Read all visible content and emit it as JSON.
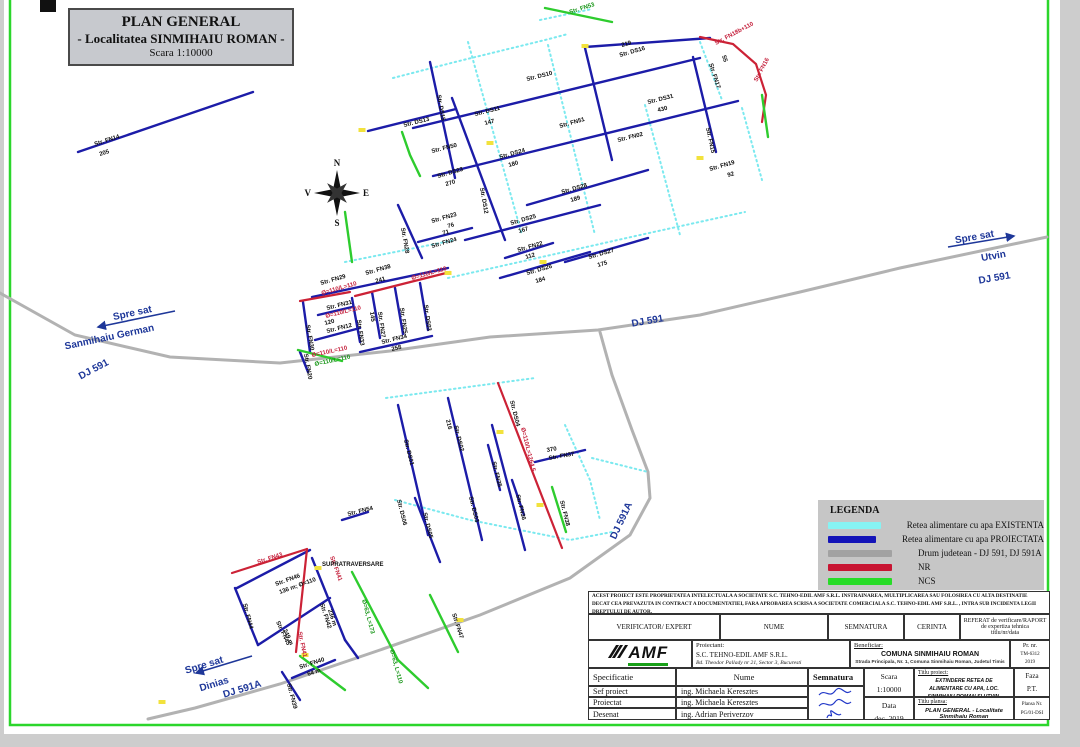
{
  "page": {
    "background": "#cdcdcd",
    "sheet": "#ffffff",
    "frame": "#2bd62b",
    "accent_blue": "#1c1ca8",
    "accent_cyan": "#7be9ef",
    "accent_red": "#cc2236",
    "accent_green": "#2ecc2e",
    "road_gray": "#b2b2b2"
  },
  "title_box": {
    "line1": "PLAN GENERAL",
    "line2": "- Localitatea SINMIHAIU ROMAN -",
    "line3": "Scara 1:10000"
  },
  "compass": {
    "n": "N",
    "e": "E",
    "s": "S",
    "v": "V"
  },
  "legend": {
    "title": "LEGENDA",
    "items": [
      {
        "color": "#86f3f3",
        "label": "Retea alimentare cu apa EXISTENTA"
      },
      {
        "color": "#1414b8",
        "label": "Retea alimentare cu apa PROIECTATA"
      },
      {
        "color": "#a2a2a2",
        "label": "Drum judetean - DJ 591, DJ 591A"
      },
      {
        "color": "#c81432",
        "label": "NR"
      },
      {
        "color": "#28dc28",
        "label": "NCS"
      }
    ]
  },
  "map": {
    "road_labels": [
      {
        "t": "Spre sat",
        "x": 975,
        "y": 240,
        "r": -10,
        "s": 10
      },
      {
        "t": "Utvin",
        "x": 994,
        "y": 259,
        "r": -10,
        "s": 10
      },
      {
        "t": "DJ 591",
        "x": 995,
        "y": 281,
        "r": -10,
        "s": 9
      },
      {
        "t": "Spre sat",
        "x": 133,
        "y": 316,
        "r": -12,
        "s": 10
      },
      {
        "t": "Sanmihaiu German",
        "x": 110,
        "y": 340,
        "r": -12,
        "s": 10
      },
      {
        "t": "DJ 591",
        "x": 95,
        "y": 372,
        "r": -28,
        "s": 9
      },
      {
        "t": "DJ 591",
        "x": 648,
        "y": 324,
        "r": -10,
        "s": 9
      },
      {
        "t": "DJ 591A",
        "x": 624,
        "y": 522,
        "r": -65,
        "s": 9
      },
      {
        "t": "Spre sat",
        "x": 205,
        "y": 668,
        "r": -17,
        "s": 10
      },
      {
        "t": "Dinias",
        "x": 215,
        "y": 687,
        "r": -17,
        "s": 10
      },
      {
        "t": "DJ 591A",
        "x": 243,
        "y": 692,
        "r": -17,
        "s": 9
      }
    ],
    "labels": [
      {
        "t": "Str. FN14",
        "x": 95,
        "y": 146,
        "r": -18
      },
      {
        "t": "205",
        "x": 100,
        "y": 156,
        "r": -18
      },
      {
        "t": "Str. DS15",
        "x": 437,
        "y": 95,
        "r": 80
      },
      {
        "t": "Str. DS13",
        "x": 404,
        "y": 127,
        "r": -14
      },
      {
        "t": "Str. FN50",
        "x": 432,
        "y": 153,
        "r": -14
      },
      {
        "t": "Str. DS11",
        "x": 475,
        "y": 116,
        "r": -14
      },
      {
        "t": "147",
        "x": 485,
        "y": 125,
        "r": -14
      },
      {
        "t": "Str. DS10",
        "x": 527,
        "y": 81,
        "r": -14
      },
      {
        "t": "Str. DS16",
        "x": 620,
        "y": 57,
        "r": -16
      },
      {
        "t": "219",
        "x": 622,
        "y": 47,
        "r": -16
      },
      {
        "t": "Str. FN53",
        "x": 570,
        "y": 14,
        "r": -18,
        "c": "g"
      },
      {
        "t": "Str. FN18b+110",
        "x": 716,
        "y": 45,
        "r": -28,
        "c": "r"
      },
      {
        "t": "Str. FN16",
        "x": 757,
        "y": 82,
        "r": -62,
        "c": "r"
      },
      {
        "t": "Str. FN17",
        "x": 709,
        "y": 64,
        "r": 72
      },
      {
        "t": "55",
        "x": 722,
        "y": 56,
        "r": 72
      },
      {
        "t": "Str. DS31",
        "x": 648,
        "y": 104,
        "r": -14
      },
      {
        "t": "430",
        "x": 658,
        "y": 112,
        "r": -14
      },
      {
        "t": "Str. FN15",
        "x": 706,
        "y": 128,
        "r": 78
      },
      {
        "t": "Str. FN51",
        "x": 560,
        "y": 128,
        "r": -16
      },
      {
        "t": "Str. FN02",
        "x": 618,
        "y": 142,
        "r": -14
      },
      {
        "t": "Str. DS12",
        "x": 480,
        "y": 188,
        "r": 80
      },
      {
        "t": "Str. DS23",
        "x": 438,
        "y": 178,
        "r": -16
      },
      {
        "t": "270",
        "x": 446,
        "y": 186,
        "r": -16
      },
      {
        "t": "Str. DS24",
        "x": 500,
        "y": 159,
        "r": -16
      },
      {
        "t": "180",
        "x": 509,
        "y": 167,
        "r": -16
      },
      {
        "t": "Str. DS28",
        "x": 562,
        "y": 194,
        "r": -16
      },
      {
        "t": "189",
        "x": 571,
        "y": 202,
        "r": -16
      },
      {
        "t": "Str. DS25",
        "x": 511,
        "y": 225,
        "r": -16
      },
      {
        "t": "167",
        "x": 519,
        "y": 233,
        "r": -16
      },
      {
        "t": "Str. FN22",
        "x": 518,
        "y": 252,
        "r": -16
      },
      {
        "t": "112",
        "x": 526,
        "y": 259,
        "r": -16
      },
      {
        "t": "Str. DS26",
        "x": 527,
        "y": 275,
        "r": -16
      },
      {
        "t": "184",
        "x": 536,
        "y": 283,
        "r": -16
      },
      {
        "t": "Str. DS27",
        "x": 589,
        "y": 259,
        "r": -16
      },
      {
        "t": "175",
        "x": 598,
        "y": 267,
        "r": -16
      },
      {
        "t": "Str. FN19",
        "x": 710,
        "y": 171,
        "r": -16
      },
      {
        "t": "92",
        "x": 728,
        "y": 177,
        "r": -16
      },
      {
        "t": "Str. FN23",
        "x": 432,
        "y": 223,
        "r": -16
      },
      {
        "t": "76",
        "x": 448,
        "y": 228,
        "r": -16
      },
      {
        "t": "71",
        "x": 443,
        "y": 235,
        "r": -16
      },
      {
        "t": "Str. FN24",
        "x": 432,
        "y": 248,
        "r": -16
      },
      {
        "t": "Str. FN38",
        "x": 366,
        "y": 275,
        "r": -16
      },
      {
        "t": "241",
        "x": 376,
        "y": 283,
        "r": -16
      },
      {
        "t": "Str. FN29",
        "x": 321,
        "y": 285,
        "r": -16
      },
      {
        "t": "Ø=110/L=110",
        "x": 322,
        "y": 295,
        "r": -16,
        "c": "r"
      },
      {
        "t": "Ø=110/L=110",
        "x": 412,
        "y": 280,
        "r": -16,
        "c": "r"
      },
      {
        "t": "Str. FN31",
        "x": 327,
        "y": 310,
        "r": -14
      },
      {
        "t": "Ø=110/L=110",
        "x": 326,
        "y": 318,
        "r": -14,
        "c": "r"
      },
      {
        "t": "120",
        "x": 325,
        "y": 325,
        "r": -14
      },
      {
        "t": "Str. FN12",
        "x": 327,
        "y": 333,
        "r": -14
      },
      {
        "t": "Str. FN30",
        "x": 306,
        "y": 325,
        "r": 80
      },
      {
        "t": "Str. FN33",
        "x": 357,
        "y": 320,
        "r": 82
      },
      {
        "t": "145",
        "x": 370,
        "y": 312,
        "r": 82
      },
      {
        "t": "Str. FN27",
        "x": 378,
        "y": 312,
        "r": 82
      },
      {
        "t": "Str. FN25",
        "x": 400,
        "y": 308,
        "r": 82
      },
      {
        "t": "Str. DS03",
        "x": 424,
        "y": 305,
        "r": 82
      },
      {
        "t": "Str. FN28",
        "x": 401,
        "y": 228,
        "r": 80
      },
      {
        "t": "Str. FN34",
        "x": 382,
        "y": 344,
        "r": -14
      },
      {
        "t": "258",
        "x": 392,
        "y": 351,
        "r": -14
      },
      {
        "t": "Str. FN20",
        "x": 304,
        "y": 354,
        "r": 80
      },
      {
        "t": "Ø=110/L=110",
        "x": 312,
        "y": 357,
        "r": -12,
        "c": "r"
      },
      {
        "t": "Ø=110/L=110",
        "x": 315,
        "y": 366,
        "r": -12,
        "c": "g"
      },
      {
        "t": "Str. DS04",
        "x": 510,
        "y": 401,
        "r": 76
      },
      {
        "t": "Ø=110/L=1264.5",
        "x": 521,
        "y": 428,
        "r": 76,
        "c": "r"
      },
      {
        "t": "216",
        "x": 446,
        "y": 420,
        "r": 76
      },
      {
        "t": "Str. DS02",
        "x": 454,
        "y": 426,
        "r": 76
      },
      {
        "t": "Str. DS01",
        "x": 404,
        "y": 440,
        "r": 76
      },
      {
        "t": "Str. DS06",
        "x": 397,
        "y": 500,
        "r": 76
      },
      {
        "t": "Str. DS05",
        "x": 423,
        "y": 513,
        "r": 76
      },
      {
        "t": "Str. FN35",
        "x": 492,
        "y": 462,
        "r": 76
      },
      {
        "t": "Str. DS03",
        "x": 469,
        "y": 497,
        "r": 76
      },
      {
        "t": "370",
        "x": 547,
        "y": 452,
        "r": -10
      },
      {
        "t": "Str. FN37",
        "x": 549,
        "y": 460,
        "r": -10
      },
      {
        "t": "Str. FN36",
        "x": 516,
        "y": 495,
        "r": 76
      },
      {
        "t": "Str. FN38",
        "x": 560,
        "y": 501,
        "r": 76
      },
      {
        "t": "Str. FN54",
        "x": 348,
        "y": 516,
        "r": -14
      },
      {
        "t": "Str. FN43",
        "x": 258,
        "y": 564,
        "r": -18,
        "c": "r"
      },
      {
        "t": "Str. FN41",
        "x": 330,
        "y": 557,
        "r": 70,
        "c": "r"
      },
      {
        "t": "SUPRATRAVERSARE",
        "x": 322,
        "y": 566,
        "r": 0
      },
      {
        "t": "Str. FN46",
        "x": 276,
        "y": 586,
        "r": -20
      },
      {
        "t": "136 m; Ø=110",
        "x": 280,
        "y": 594,
        "r": -20
      },
      {
        "t": "Str. FN44",
        "x": 243,
        "y": 604,
        "r": 75
      },
      {
        "t": "Str. FN45",
        "x": 276,
        "y": 622,
        "r": 65
      },
      {
        "t": "249 m",
        "x": 283,
        "y": 630,
        "r": 65
      },
      {
        "t": "Str. FN42",
        "x": 320,
        "y": 604,
        "r": 72
      },
      {
        "t": "236 m",
        "x": 328,
        "y": 610,
        "r": 72
      },
      {
        "t": "Str. FN41",
        "x": 298,
        "y": 632,
        "r": 78,
        "c": "r"
      },
      {
        "t": "Str. FN47",
        "x": 452,
        "y": 614,
        "r": 72
      },
      {
        "t": "Ø=63, L=173",
        "x": 362,
        "y": 600,
        "r": 75,
        "c": "g"
      },
      {
        "t": "Ø=63, L=110",
        "x": 390,
        "y": 650,
        "r": 75,
        "c": "g"
      },
      {
        "t": "Str. FN40",
        "x": 300,
        "y": 669,
        "r": -18
      },
      {
        "t": "64 m",
        "x": 308,
        "y": 676,
        "r": -18
      },
      {
        "t": "Str. FN39",
        "x": 287,
        "y": 684,
        "r": 75
      }
    ],
    "lines": [
      {
        "c": "road",
        "p": "0,293 75,335 170,357 280,363 390,351 490,337 598,330 700,315 800,292 900,268 1047,237"
      },
      {
        "c": "road",
        "p": "600,332 612,375 632,430 648,472 650,498 630,535 570,578 480,615 380,650 280,684 195,708 148,719"
      },
      {
        "c": "c",
        "p": "393,78 455,62 545,40 568,34"
      },
      {
        "c": "c",
        "p": "540,20 592,9"
      },
      {
        "c": "c",
        "p": "468,42 522,235"
      },
      {
        "c": "c",
        "p": "548,45 595,235"
      },
      {
        "c": "c",
        "p": "448,278 640,235 745,212"
      },
      {
        "c": "c",
        "p": "645,105 680,235"
      },
      {
        "c": "c",
        "p": "700,42 722,100"
      },
      {
        "c": "c",
        "p": "742,108 762,180"
      },
      {
        "c": "c",
        "p": "345,262 455,240"
      },
      {
        "c": "c",
        "p": "386,398 535,378"
      },
      {
        "c": "c",
        "p": "395,500 470,520 570,540 612,532"
      },
      {
        "c": "c",
        "p": "565,425 590,480 600,520"
      },
      {
        "c": "c",
        "p": "592,458 648,472"
      },
      {
        "c": "b",
        "p": "78,152 253,92"
      },
      {
        "c": "b",
        "p": "368,131 456,109"
      },
      {
        "c": "b",
        "p": "413,128 700,58"
      },
      {
        "c": "b",
        "p": "585,47 710,38"
      },
      {
        "c": "b",
        "p": "433,176 738,101"
      },
      {
        "c": "b",
        "p": "527,205 648,170"
      },
      {
        "c": "b",
        "p": "465,240 600,205"
      },
      {
        "c": "b",
        "p": "505,258 553,243"
      },
      {
        "c": "b",
        "p": "500,278 590,252"
      },
      {
        "c": "b",
        "p": "565,262 648,238"
      },
      {
        "c": "b",
        "p": "452,98 505,240"
      },
      {
        "c": "b",
        "p": "430,62 455,178"
      },
      {
        "c": "b",
        "p": "585,48 612,160"
      },
      {
        "c": "b",
        "p": "693,57 716,152"
      },
      {
        "c": "b",
        "p": "398,205 422,258"
      },
      {
        "c": "b",
        "p": "418,242 472,228"
      },
      {
        "c": "b",
        "p": "312,297 448,268"
      },
      {
        "c": "b",
        "p": "318,315 352,307"
      },
      {
        "c": "b",
        "p": "315,340 360,328"
      },
      {
        "c": "b",
        "p": "360,352 432,336"
      },
      {
        "c": "b",
        "p": "303,302 310,352"
      },
      {
        "c": "b",
        "p": "352,298 360,342"
      },
      {
        "c": "b",
        "p": "372,292 380,338"
      },
      {
        "c": "b",
        "p": "395,288 403,334"
      },
      {
        "c": "b",
        "p": "420,283 428,330"
      },
      {
        "c": "b",
        "p": "300,352 308,372"
      },
      {
        "c": "b",
        "p": "398,405 428,535"
      },
      {
        "c": "b",
        "p": "448,398 482,540"
      },
      {
        "c": "b",
        "p": "492,425 525,550"
      },
      {
        "c": "b",
        "p": "488,445 500,490"
      },
      {
        "c": "b",
        "p": "512,480 524,515"
      },
      {
        "c": "b",
        "p": "535,462 585,450"
      },
      {
        "c": "b",
        "p": "415,498 440,562"
      },
      {
        "c": "b",
        "p": "342,520 368,512"
      },
      {
        "c": "b",
        "p": "237,588 310,550"
      },
      {
        "c": "b",
        "p": "235,588 258,645"
      },
      {
        "c": "b",
        "p": "258,645 330,598"
      },
      {
        "c": "b",
        "p": "312,558 345,640"
      },
      {
        "c": "b",
        "p": "292,678 335,660"
      },
      {
        "c": "b",
        "p": "282,672 300,700"
      },
      {
        "c": "b",
        "p": "345,640 358,658"
      },
      {
        "c": "r",
        "p": "300,301 350,292"
      },
      {
        "c": "r",
        "p": "355,296 450,272"
      },
      {
        "c": "r",
        "p": "700,37 733,44 756,64 766,95 762,122"
      },
      {
        "c": "r",
        "p": "498,383 562,548"
      },
      {
        "c": "r",
        "p": "232,573 307,549"
      },
      {
        "c": "r",
        "p": "307,549 296,652"
      },
      {
        "c": "g",
        "p": "545,8 612,22"
      },
      {
        "c": "g",
        "p": "402,132 410,155 420,176"
      },
      {
        "c": "g",
        "p": "345,212 352,262"
      },
      {
        "c": "g",
        "p": "762,95 768,137"
      },
      {
        "c": "g",
        "p": "298,350 342,361"
      },
      {
        "c": "g",
        "p": "552,487 566,532"
      },
      {
        "c": "g",
        "p": "352,572 398,660"
      },
      {
        "c": "g",
        "p": "430,595 458,652"
      },
      {
        "c": "g",
        "p": "300,656 345,690"
      },
      {
        "c": "g",
        "p": "398,660 428,688"
      }
    ],
    "arrows": [
      {
        "x1": 948,
        "y1": 247,
        "x2": 1014,
        "y2": 236
      },
      {
        "x1": 175,
        "y1": 311,
        "x2": 98,
        "y2": 327
      },
      {
        "x1": 252,
        "y1": 656,
        "x2": 196,
        "y2": 673
      }
    ],
    "marks": [
      {
        "x": 362,
        "y": 130
      },
      {
        "x": 490,
        "y": 143
      },
      {
        "x": 543,
        "y": 262
      },
      {
        "x": 448,
        "y": 273
      },
      {
        "x": 585,
        "y": 46
      },
      {
        "x": 500,
        "y": 432
      },
      {
        "x": 540,
        "y": 505
      },
      {
        "x": 460,
        "y": 620
      },
      {
        "x": 305,
        "y": 655
      },
      {
        "x": 162,
        "y": 702
      },
      {
        "x": 318,
        "y": 568
      },
      {
        "x": 700,
        "y": 158
      }
    ]
  },
  "title_block": {
    "disclaimer": "ACEST PROIECT ESTE PROPRIETATEA INTELECTUALA A SOCIETATE S.C. TEHNO-EDIL AMF S.R.L. INSTRAINAREA, MULTIPLICAREA SAU FOLOSIREA CU ALTA DESTINATIE DECAT CEA PREVAZUTA IN CONTRACT A DOCUMENTATIEI, FARA APROBAREA SCRISA A SOCIETATE COMERCIALA S.C. TEHNO-EDIL AMF S.R.L. , INTRA SUB INCIDENTA LEGII DREPTULUI DE AUTOR.",
    "verificator": "VERIFICATOR/ EXPERT",
    "nume_hdr": "NUME",
    "semnatura_hdr": "SEMNATURA",
    "cerinta_hdr": "CERINTA",
    "referat1": "REFERAT  de verificare/RAPORT  de expertiza tehnica",
    "referat2": "titlu/nr/data",
    "logo_text": "AMF",
    "proiectant_label": "Proiectant:",
    "proiectant_name": "S.C. TEHNO-EDIL AMF S.R.L.",
    "proiectant_addr": "Bd. Theodor Pallady nr 21, Sector 3, Bucuresti",
    "beneficiar_label": "Beneficiar:",
    "beneficiar_name": "COMUNA SINMIHAIU ROMAN",
    "beneficiar_addr": "Strada Principala, Nr. 1, Comuna Sinmihaiu Roman, Judetul Timis",
    "pr_nr_label": "Pr. nr.",
    "pr_nr": "TM-6312",
    "pr_an": "2019",
    "specificatie_hdr": "Specificatie",
    "nume2_hdr": "Nume",
    "semnatura2_hdr": "Semnatura",
    "scara_label": "Scara",
    "scara": "1:10000",
    "titlu_proiect_label": "Titlu proiect:",
    "titlu_proiect": "EXTINDERE RETEA DE ALIMENTARE CU APA, LOC. SINMIHAIU ROMAN SI UTVIN, COMUNA SINMIHAIU ROMAN, JUD.TIMIS",
    "faza_label": "Faza",
    "faza": "P.T.",
    "rows": [
      {
        "spec": "Sef proiect",
        "name": "ing. Michaela Keresztes"
      },
      {
        "spec": "Proiectat",
        "name": "ing. Michaela Keresztes"
      },
      {
        "spec": "Desenat",
        "name": "ing. Adrian Periverzov"
      }
    ],
    "data_label": "Data",
    "data": "dec. 2019",
    "titlu_plansa_label": "Titlu plansa:",
    "titlu_plansa": "PLAN GENERAL - Localitate Sinmihaiu Roman",
    "plansa_label": "Plansa Nr.",
    "plansa": "PG/01-DSI"
  }
}
